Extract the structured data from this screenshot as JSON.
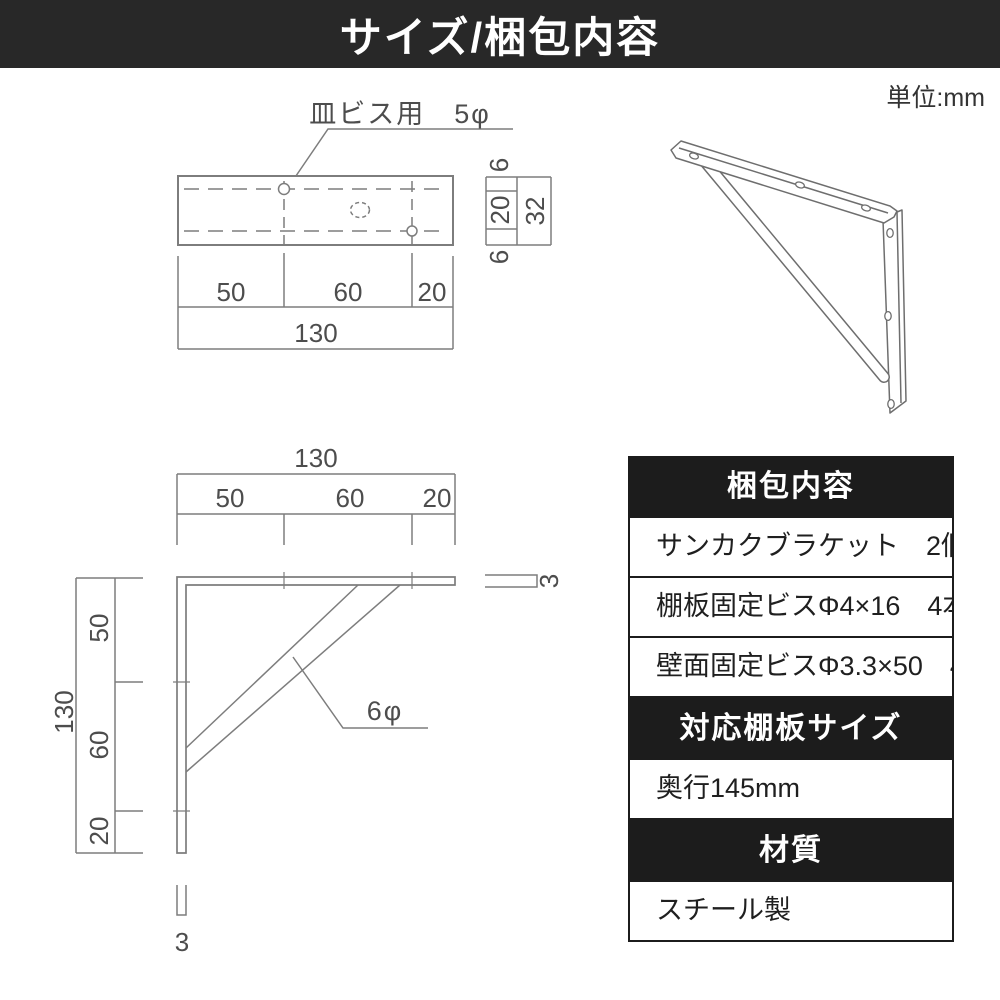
{
  "title_bar": {
    "title": "サイズ/梱包内容"
  },
  "unit_label": "単位:mm",
  "colors": {
    "title_bar_bg": "#282828",
    "table_header_bg": "#1c1c1c",
    "drawing_line": "#7d7d7d",
    "illustration_line": "#6e6e6e",
    "dim_text": "#4d4d4d"
  },
  "top_view": {
    "screw_label": "皿ビス用　5φ",
    "dims": {
      "seg1": "50",
      "seg2": "60",
      "seg3": "20",
      "total": "130"
    },
    "profile_dims": {
      "top": "6",
      "middle": "20",
      "bottom": "6",
      "total": "32"
    }
  },
  "side_view": {
    "dims_top": {
      "seg1": "50",
      "seg2": "60",
      "seg3": "20",
      "total": "130"
    },
    "dims_left": {
      "seg1": "50",
      "seg2": "60",
      "seg3": "20",
      "total": "130"
    },
    "rod_label": "6φ",
    "thickness_right": "3",
    "thickness_bottom": "3"
  },
  "table": {
    "sections": [
      {
        "header": "梱包内容",
        "rows": [
          "サンカクブラケット　2個",
          "棚板固定ビスΦ4×16　4本",
          "壁面固定ビスΦ3.3×50　4本"
        ]
      },
      {
        "header": "対応棚板サイズ",
        "rows": [
          "奥行145mm"
        ]
      },
      {
        "header": "材質",
        "rows": [
          "スチール製"
        ]
      }
    ]
  }
}
